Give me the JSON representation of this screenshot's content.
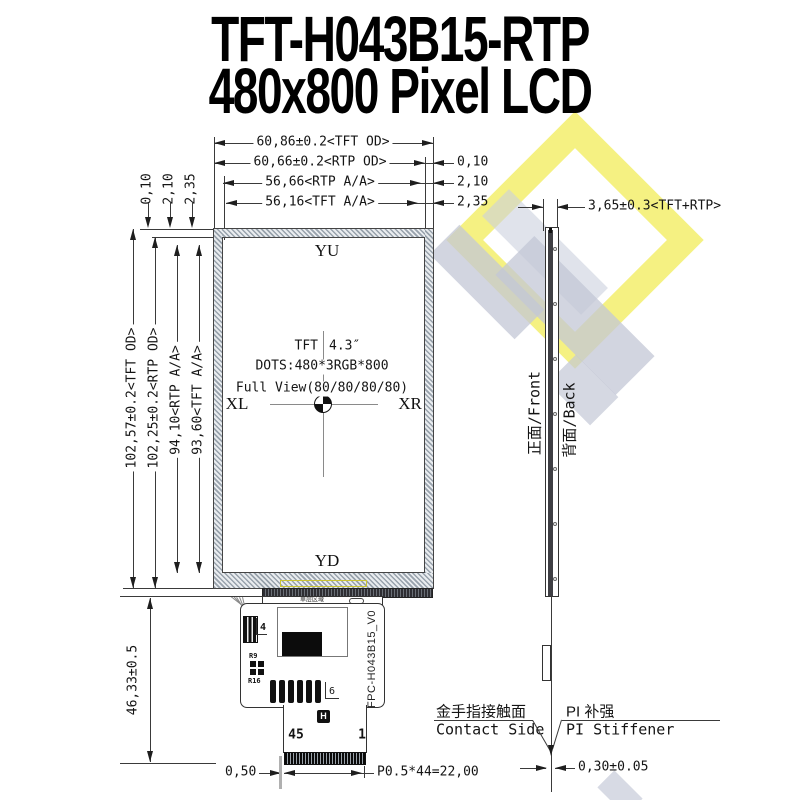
{
  "title": {
    "line1": "TFT-H043B15-RTP",
    "line2": "480x800 Pixel LCD"
  },
  "top_dims": {
    "d1": "60,86±0.2<TFT OD>",
    "d2": "60,66±0.2<RTP OD>",
    "d3": "56,66<RTP A/A>",
    "d4": "56,16<TFT A/A>",
    "o1": "0,10",
    "o2": "2,10",
    "o3": "2,35",
    "left_o1": "0,10",
    "left_o2": "2,10",
    "left_o3": "2,35"
  },
  "left_dims": {
    "d1": "102,57±0.2<TFT OD>",
    "d2": "102,25±0.2<RTP OD>",
    "d3": "94,10<RTP A/A>",
    "d4": "93,60<TFT A/A>",
    "fpc_height": "46,33±0.5"
  },
  "panel": {
    "top": "YU",
    "bottom": "YD",
    "left": "XL",
    "right": "XR",
    "spec_1a": "TFT",
    "spec_1b": "4.3″",
    "spec_2": "DOTS:480*3RGB*800",
    "spec_3": "Full View(80/80/80/80)"
  },
  "side": {
    "dim": "3,65±0.3<TFT+RTP>",
    "front": "正面/Front",
    "back": "背面/Back",
    "contact_zh": "金手指接触面",
    "contact_en": "Contact Side",
    "pi_zh": "PI 补强",
    "pi_en": "PI Stiffener",
    "tail_dim": "0,30±0.05"
  },
  "fpc": {
    "part": "FPC-H043B15_V0",
    "pin_l": "45",
    "pin_r": "1",
    "conn": "4",
    "bars": "6",
    "r1": "R9",
    "r2": "R16",
    "area": "单层区域",
    "logo": "H"
  },
  "bottom_dims": {
    "offset": "0,50",
    "pitch": "P0.5*44=22,00"
  }
}
